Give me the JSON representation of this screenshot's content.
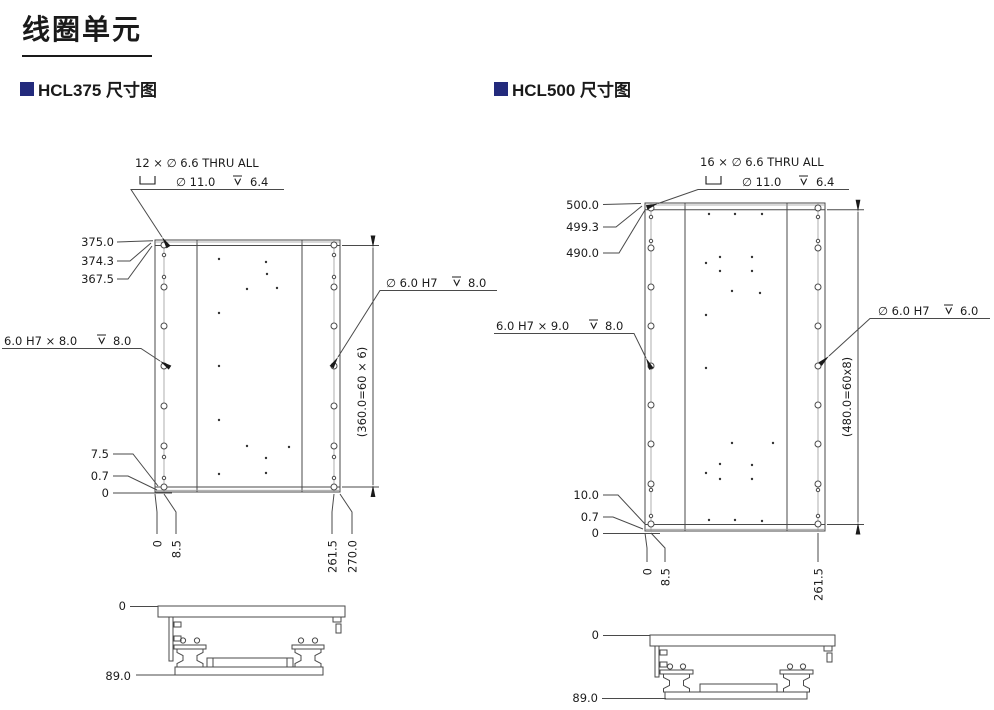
{
  "page": {
    "title": "线圈单元"
  },
  "sections": {
    "hcl375": "HCL375 尺寸图",
    "hcl500": "HCL500 尺寸图"
  },
  "colors": {
    "accent": "#232a7c",
    "line": "#4a4a4a",
    "text": "#1c1c1c"
  },
  "hcl375": {
    "thru_note": "12 × ∅ 6.6 THRU ALL",
    "cbore_dia": "∅ 11.0",
    "cbore_depth": "6.4",
    "left_dims": [
      "375.0",
      "374.3",
      "367.5"
    ],
    "side_hole_note": "6.0 H7 × 8.0",
    "side_hole_depth": "8.0",
    "right_hole_note": "∅ 6.0 H7",
    "right_hole_depth": "8.0",
    "bottom_left_dims": [
      "7.5",
      "0.7",
      "0"
    ],
    "bottom_dims": [
      "0",
      "8.5",
      "261.5",
      "270.0"
    ],
    "pitch_dim": "(360.0=60 × 6)",
    "side_view_dims": [
      "0",
      "89.0"
    ]
  },
  "hcl500": {
    "thru_note": "16 × ∅ 6.6 THRU ALL",
    "cbore_dia": "∅ 11.0",
    "cbore_depth": "6.4",
    "left_dims": [
      "500.0",
      "499.3",
      "490.0"
    ],
    "side_hole_note": "6.0 H7 × 9.0",
    "side_hole_depth": "8.0",
    "right_hole_note": "∅ 6.0 H7",
    "right_hole_depth": "6.0",
    "bottom_left_dims": [
      "10.0",
      "0.7",
      "0"
    ],
    "bottom_dims": [
      "0",
      "8.5",
      "261.5"
    ],
    "pitch_dim": "(480.0=60x8)",
    "side_view_dims": [
      "0",
      "89.0"
    ]
  }
}
